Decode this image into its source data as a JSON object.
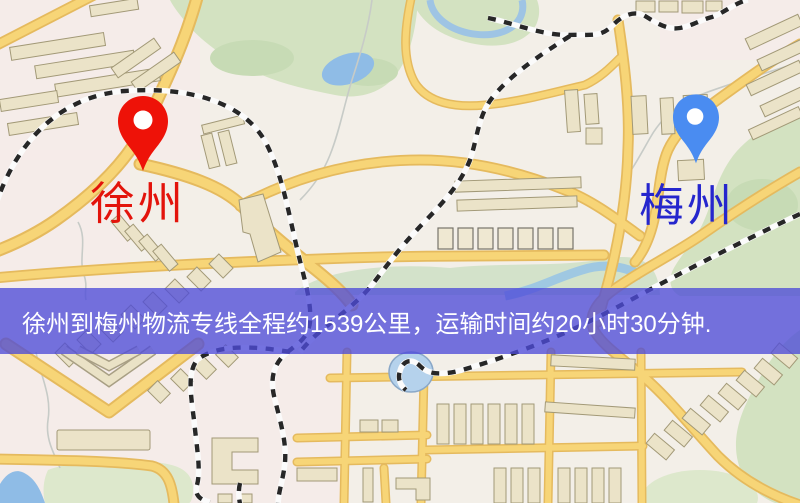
{
  "map": {
    "origin": {
      "label": "徐州",
      "marker_color": "#ee1208",
      "label_color": "#e3130b"
    },
    "destination": {
      "label": "梅州",
      "marker_color": "#4a8cf1",
      "label_color": "#2526cd"
    },
    "banner": {
      "text": "徐州到梅州物流专线全程约1539公里，运输时间约20小时30分钟.",
      "bg_color": "rgba(78,76,217,0.78)",
      "text_color": "#ffffff"
    },
    "route": {
      "distance": "约1539公里",
      "duration": "约20小时30分钟"
    },
    "legend_colors": {
      "road": "#f7d577",
      "railway": "#272727",
      "park": "#d3e2c1",
      "water": "#90bce6",
      "building": "#ebe3c8",
      "base": "#f3efe8"
    }
  }
}
